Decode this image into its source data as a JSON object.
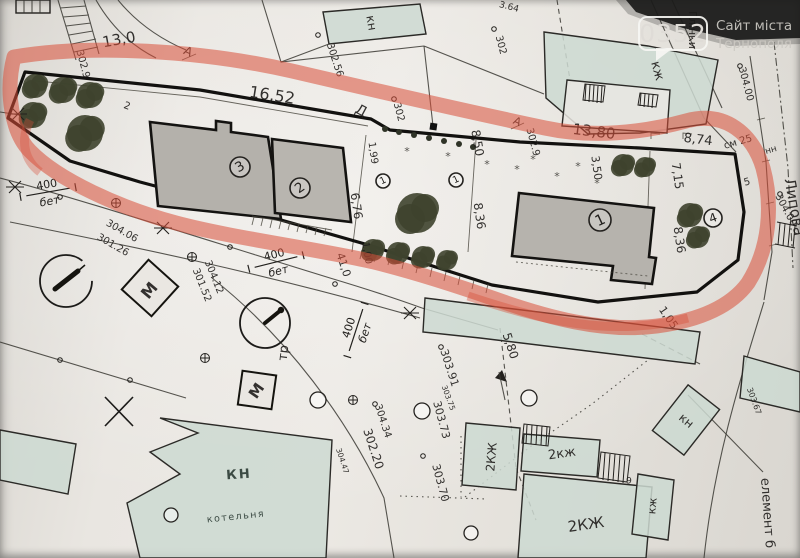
{
  "watermark": {
    "code": "0352",
    "site_line1": "Сайт міста",
    "site_line2": "Тернополя"
  },
  "colors": {
    "paper": "#e7e4df",
    "ink": "#23211e",
    "marker_red": "#d84e38",
    "building_gray": "#b6b3ae",
    "building_green": "#cdd9d1",
    "watermark_bg": "#1b1b1a",
    "watermark_text": "#dfdcd7"
  },
  "map": {
    "street_names": [
      "Липова",
      "Глінки"
    ],
    "labels": [
      {
        "t": "13,0",
        "x": 119,
        "y": 40,
        "r": -10,
        "s": 15
      },
      {
        "t": "302.9",
        "x": 83,
        "y": 64,
        "r": 75,
        "s": 10
      },
      {
        "t": "2",
        "x": 127,
        "y": 106,
        "r": 20,
        "s": 10
      },
      {
        "t": "А",
        "x": 188,
        "y": 52,
        "r": 25,
        "s": 12
      },
      {
        "t": "16,52",
        "x": 272,
        "y": 96,
        "r": 9,
        "s": 16
      },
      {
        "t": "Д",
        "x": 361,
        "y": 111,
        "r": 28,
        "s": 14
      },
      {
        "t": "302",
        "x": 399,
        "y": 112,
        "r": 75,
        "s": 10
      },
      {
        "t": "8,50",
        "x": 477,
        "y": 143,
        "r": 80,
        "s": 12
      },
      {
        "t": "А",
        "x": 517,
        "y": 122,
        "r": 25,
        "s": 11
      },
      {
        "t": "302.9",
        "x": 533,
        "y": 142,
        "r": 75,
        "s": 10
      },
      {
        "t": "13,80",
        "x": 594,
        "y": 132,
        "r": 7,
        "s": 15
      },
      {
        "t": "8,74",
        "x": 698,
        "y": 140,
        "r": 7,
        "s": 13
      },
      {
        "t": "см 25",
        "x": 738,
        "y": 142,
        "r": -16,
        "s": 10
      },
      {
        "t": "нн",
        "x": 771,
        "y": 150,
        "r": -16,
        "s": 9
      },
      {
        "t": "5",
        "x": 747,
        "y": 182,
        "r": -15,
        "s": 10
      },
      {
        "t": "302.56",
        "x": 335,
        "y": 60,
        "r": 72,
        "s": 10
      },
      {
        "t": "302",
        "x": 501,
        "y": 45,
        "r": 75,
        "s": 10
      },
      {
        "t": "3.64",
        "x": 509,
        "y": 7,
        "r": 15,
        "s": 9
      },
      {
        "t": "кн",
        "x": 371,
        "y": 23,
        "r": 80,
        "s": 12
      },
      {
        "t": "кж",
        "x": 657,
        "y": 71,
        "r": 75,
        "s": 13
      },
      {
        "t": "Глінки",
        "x": 692,
        "y": 30,
        "r": 90,
        "s": 11
      },
      {
        "t": "Липова",
        "x": 794,
        "y": 207,
        "r": 80,
        "s": 15
      },
      {
        "t": "304.00",
        "x": 746,
        "y": 84,
        "r": 75,
        "s": 10
      },
      {
        "t": "304.00",
        "x": 786,
        "y": 210,
        "r": 62,
        "s": 10
      },
      {
        "t": "3,50",
        "x": 596,
        "y": 168,
        "r": 82,
        "s": 11
      },
      {
        "t": "7,15",
        "x": 677,
        "y": 176,
        "r": 82,
        "s": 12
      },
      {
        "t": "8,36",
        "x": 679,
        "y": 240,
        "r": 82,
        "s": 12
      },
      {
        "t": "8,36",
        "x": 479,
        "y": 216,
        "r": 82,
        "s": 12
      },
      {
        "t": "1,99",
        "x": 373,
        "y": 153,
        "r": 82,
        "s": 10
      },
      {
        "t": "6,76",
        "x": 356,
        "y": 206,
        "r": 82,
        "s": 12
      },
      {
        "t": "1,00",
        "x": 367,
        "y": 253,
        "r": 80,
        "s": 10
      },
      {
        "t": "41,0",
        "x": 343,
        "y": 265,
        "r": 72,
        "s": 11
      },
      {
        "t": "1,05",
        "x": 668,
        "y": 318,
        "r": 55,
        "s": 11
      },
      {
        "t": "5,80",
        "x": 510,
        "y": 346,
        "r": 72,
        "s": 12
      },
      {
        "t": "303.91",
        "x": 449,
        "y": 368,
        "r": 72,
        "s": 11
      },
      {
        "t": "303.75",
        "x": 448,
        "y": 398,
        "r": 70,
        "s": 7.5
      },
      {
        "t": "303.73",
        "x": 441,
        "y": 420,
        "r": 75,
        "s": 11
      },
      {
        "t": "303.70",
        "x": 440,
        "y": 483,
        "r": 75,
        "s": 11
      },
      {
        "t": "304.34",
        "x": 383,
        "y": 421,
        "r": 72,
        "s": 10
      },
      {
        "t": "302.20",
        "x": 373,
        "y": 449,
        "r": 72,
        "s": 12
      },
      {
        "t": "304.47",
        "x": 342,
        "y": 461,
        "r": 72,
        "s": 7.5
      },
      {
        "t": "304.12",
        "x": 214,
        "y": 277,
        "r": 68,
        "s": 10
      },
      {
        "t": "301.52",
        "x": 202,
        "y": 285,
        "r": 68,
        "s": 10
      },
      {
        "t": "304.06",
        "x": 122,
        "y": 231,
        "r": 30,
        "s": 10
      },
      {
        "t": "301.26",
        "x": 113,
        "y": 245,
        "r": 30,
        "s": 10
      },
      {
        "t": "303.67",
        "x": 754,
        "y": 401,
        "r": 70,
        "s": 8
      },
      {
        "t": "тр",
        "x": 284,
        "y": 353,
        "r": -83,
        "s": 13
      },
      {
        "t": "М",
        "x": 150,
        "y": 291,
        "r": -50,
        "s": 16,
        "w": 1
      },
      {
        "t": "М",
        "x": 257,
        "y": 391,
        "r": -55,
        "s": 15,
        "w": 1
      },
      {
        "t": "КН",
        "x": 239,
        "y": 475,
        "r": -4,
        "s": 13,
        "c": "#2e3d36",
        "w": 1,
        "sp": 2
      },
      {
        "t": "котельня",
        "x": 236,
        "y": 517,
        "r": -6,
        "s": 9.5,
        "c": "#2e3d36",
        "sp": 1.5
      },
      {
        "t": "2КЖ",
        "x": 492,
        "y": 457,
        "r": -85,
        "s": 12
      },
      {
        "t": "2кж",
        "x": 562,
        "y": 454,
        "r": -8,
        "s": 13
      },
      {
        "t": "2КЖ",
        "x": 586,
        "y": 525,
        "r": -8,
        "s": 15
      },
      {
        "t": "9",
        "x": 629,
        "y": 481,
        "r": 0,
        "s": 9
      },
      {
        "t": "кж",
        "x": 653,
        "y": 506,
        "r": -85,
        "s": 11
      },
      {
        "t": "кн",
        "x": 686,
        "y": 421,
        "r": 40,
        "s": 12
      },
      {
        "t": "елемент б",
        "x": 767,
        "y": 513,
        "r": 86,
        "s": 13
      }
    ],
    "circled_numbers": [
      {
        "n": "3",
        "x": 240,
        "y": 167,
        "rad": 10,
        "rot": -30
      },
      {
        "n": "2",
        "x": 300,
        "y": 188,
        "rad": 10,
        "rot": -35
      },
      {
        "n": "1",
        "x": 600,
        "y": 220,
        "rad": 11,
        "rot": -25
      },
      {
        "n": "4",
        "x": 713,
        "y": 218,
        "rad": 9,
        "rot": -20
      },
      {
        "n": "1",
        "x": 383,
        "y": 181,
        "rad": 7,
        "rot": -25
      },
      {
        "n": "1",
        "x": 456,
        "y": 180,
        "rad": 7,
        "rot": -25
      }
    ],
    "road_fractions": [
      {
        "top": "400",
        "bottom": "бет",
        "x": 48,
        "y": 192,
        "r": -10
      },
      {
        "top": "400",
        "bottom": "бет",
        "x": 276,
        "y": 262,
        "r": -14
      },
      {
        "top": "400",
        "bottom": "бет",
        "x": 356,
        "y": 330,
        "r": -72
      }
    ],
    "trees": [
      [
        35,
        86,
        12
      ],
      [
        63,
        90,
        13
      ],
      [
        90,
        95,
        13
      ],
      [
        33,
        115,
        13
      ],
      [
        85,
        133,
        18
      ],
      [
        417,
        213,
        20
      ],
      [
        373,
        250,
        11
      ],
      [
        398,
        253,
        11
      ],
      [
        423,
        257,
        11
      ],
      [
        447,
        260,
        10
      ],
      [
        623,
        165,
        11
      ],
      [
        645,
        167,
        10
      ],
      [
        690,
        215,
        12
      ],
      [
        698,
        237,
        11
      ]
    ],
    "hedge_dots": [
      [
        385,
        129
      ],
      [
        399,
        132
      ],
      [
        414,
        135
      ],
      [
        429,
        138
      ],
      [
        444,
        141
      ],
      [
        459,
        144
      ],
      [
        473,
        147
      ]
    ],
    "paving_marks": [
      [
        407,
        155
      ],
      [
        448,
        160
      ],
      [
        487,
        168
      ],
      [
        517,
        173
      ],
      [
        557,
        180
      ],
      [
        597,
        187
      ],
      [
        533,
        163
      ],
      [
        578,
        170
      ]
    ],
    "survey_crosses": [
      [
        15,
        187
      ],
      [
        163,
        228
      ],
      [
        410,
        313
      ],
      [
        18,
        114
      ]
    ],
    "circle_cross_marks": [
      [
        116,
        203
      ],
      [
        192,
        257
      ],
      [
        205,
        358
      ],
      [
        353,
        400
      ]
    ],
    "small_circles": [
      [
        318,
        400,
        8
      ],
      [
        171,
        515,
        7
      ],
      [
        422,
        411,
        8
      ],
      [
        471,
        533,
        7
      ],
      [
        529,
        398,
        8
      ]
    ],
    "point_dots": [
      [
        394,
        99
      ],
      [
        318,
        35
      ],
      [
        494,
        29
      ],
      [
        740,
        66
      ],
      [
        780,
        194
      ],
      [
        441,
        347
      ],
      [
        423,
        456
      ],
      [
        375,
        404
      ],
      [
        60,
        197
      ],
      [
        230,
        247
      ],
      [
        335,
        284
      ],
      [
        60,
        360
      ],
      [
        130,
        380
      ]
    ]
  }
}
